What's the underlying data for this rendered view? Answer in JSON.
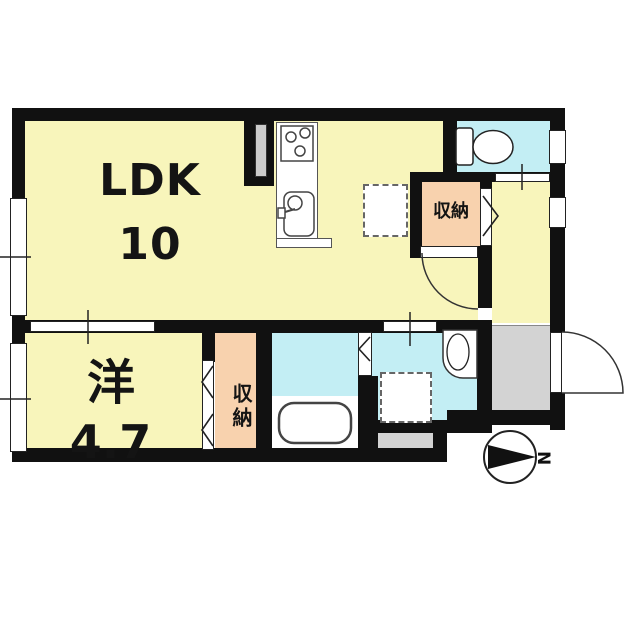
{
  "floorplan": {
    "type": "apartment-floor-plan",
    "labels": {
      "ldk_name": "LDK",
      "ldk_size": "10",
      "western_name": "洋",
      "western_size": "4.7",
      "storage_top": "収納",
      "storage_bottom": "収納",
      "compass_north": "N"
    },
    "colors": {
      "room_floor_yellow": "#F8F5BB",
      "wet_area_cyan": "#C3EEF4",
      "storage_peach": "#F8D2AE",
      "entry_gray": "#D3D3D3",
      "wall_black": "#111111",
      "outline": "#333333"
    }
  }
}
